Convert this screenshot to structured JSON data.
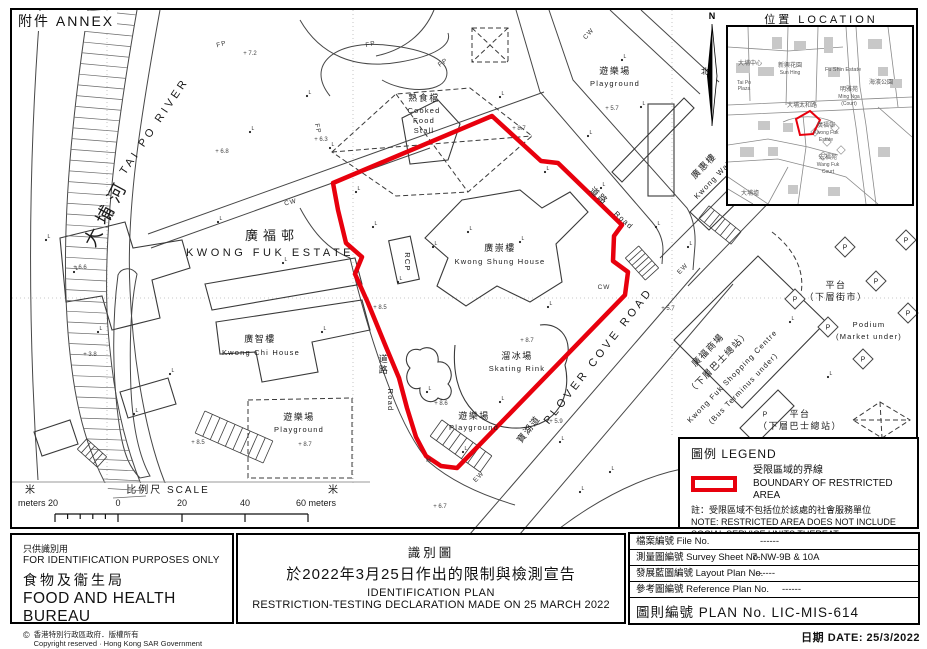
{
  "annex": "附件 ANNEX",
  "red": "#e8000d",
  "inset": {
    "title": "位置 LOCATION",
    "north": "N",
    "north_cn": "北",
    "red_poly": [
      [
        68,
        92
      ],
      [
        82,
        84
      ],
      [
        92,
        93
      ],
      [
        85,
        107
      ],
      [
        72,
        108
      ]
    ],
    "labels": [
      {
        "t": "新興花園",
        "x": 62,
        "y": 40,
        "s": 6
      },
      {
        "t": "Sun Hing",
        "x": 62,
        "y": 47,
        "s": 5
      },
      {
        "t": "Fu Shin Estate",
        "x": 115,
        "y": 44,
        "s": 5.5
      },
      {
        "t": "大埔中心",
        "x": 22,
        "y": 38,
        "s": 6
      },
      {
        "t": "Tai Po",
        "x": 16,
        "y": 57,
        "s": 5
      },
      {
        "t": "Plaza",
        "x": 16,
        "y": 63,
        "s": 5
      },
      {
        "t": "明雅苑",
        "x": 121,
        "y": 64,
        "s": 6
      },
      {
        "t": "Ming Nga",
        "x": 121,
        "y": 71,
        "s": 5
      },
      {
        "t": "(Court)",
        "x": 121,
        "y": 78,
        "s": 5
      },
      {
        "t": "大埔太和路",
        "x": 74,
        "y": 80,
        "s": 6
      },
      {
        "t": "海濱公園",
        "x": 153,
        "y": 57,
        "s": 6
      },
      {
        "t": "廣福邨",
        "x": 98,
        "y": 100,
        "s": 6
      },
      {
        "t": "Kwong Fuk",
        "x": 98,
        "y": 107,
        "s": 5
      },
      {
        "t": "Estate",
        "x": 98,
        "y": 114,
        "s": 5
      },
      {
        "t": "宏福苑",
        "x": 100,
        "y": 132,
        "s": 6
      },
      {
        "t": "Wang Fuk",
        "x": 100,
        "y": 139,
        "s": 5
      },
      {
        "t": "Court",
        "x": 100,
        "y": 146,
        "s": 5
      },
      {
        "t": "大埔墟",
        "x": 22,
        "y": 168,
        "s": 6
      }
    ]
  },
  "legend": {
    "title": "圖例 LEGEND",
    "item_cn": "受限區域的界線",
    "item_en": "BOUNDARY OF RESTRICTED AREA",
    "note_cn": "註：受限區域不包括位於該處的社會服務單位",
    "note_en1": "NOTE: RESTRICTED AREA DOES NOT INCLUDE",
    "note_en2": "SOCIAL SERVICE UNITS THEREAT"
  },
  "scalebar": {
    "cn_left": "米",
    "cn_right": "米",
    "title": "比例尺  SCALE",
    "left_label": "meters 20",
    "zero": "0",
    "tick20": "20",
    "tick40": "40",
    "right_label": "60 meters"
  },
  "title_block": {
    "use_cn": "只供識別用",
    "use_en": "FOR IDENTIFICATION PURPOSES ONLY",
    "bureau_cn": "食物及衞生局",
    "bureau_en": "FOOD AND HEALTH BUREAU",
    "copy_symbol": "©",
    "copy_cn": "香港特別行政區政府．版權所有",
    "copy_en": "Copyright reserved · Hong Kong SAR Government"
  },
  "plan_title": {
    "cn1": "識別圖",
    "cn2": "於2022年3月25日作出的限制與檢測宣告",
    "en1": "IDENTIFICATION PLAN",
    "en2": "RESTRICTION-TESTING DECLARATION MADE ON 25 MARCH 2022"
  },
  "info": {
    "rows": [
      {
        "label": "檔案編號 File No.",
        "value": "------"
      },
      {
        "label": "測量圖編號 Survey Sheet No.",
        "value": "7-NW-9B  &  10A"
      },
      {
        "label": "發展藍圖編號 Layout Plan No.",
        "value": "------"
      },
      {
        "label": "參考圖編號 Reference Plan No.",
        "value": "------"
      }
    ],
    "plan_no": "圖則編號  PLAN  No.  LIC-MIS-614",
    "date": "日期  DATE:  25/3/2022"
  },
  "map": {
    "boundary": [
      [
        492,
        116
      ],
      [
        333,
        183
      ],
      [
        338,
        210
      ],
      [
        346,
        243
      ],
      [
        362,
        257
      ],
      [
        355,
        274
      ],
      [
        368,
        303
      ],
      [
        386,
        347
      ],
      [
        399,
        378
      ],
      [
        407,
        408
      ],
      [
        416,
        437
      ],
      [
        426,
        456
      ],
      [
        441,
        466
      ],
      [
        457,
        468
      ],
      [
        625,
        295
      ],
      [
        628,
        272
      ],
      [
        613,
        261
      ],
      [
        614,
        236
      ],
      [
        622,
        225
      ],
      [
        558,
        163
      ],
      [
        541,
        161
      ]
    ],
    "labels": [
      {
        "t": "大埔河",
        "x": 112,
        "y": 215,
        "r": -62,
        "c": "riv"
      },
      {
        "t": "TAI PO RIVER",
        "x": 157,
        "y": 128,
        "r": -56,
        "c": "enwide"
      },
      {
        "t": "廣福邨",
        "x": 272,
        "y": 240,
        "c": "cnbig"
      },
      {
        "t": "KWONG FUK ESTATE",
        "x": 270,
        "y": 256,
        "c": "enwide"
      },
      {
        "t": "廣崇樓",
        "x": 500,
        "y": 251,
        "c": "cn"
      },
      {
        "t": "Kwong Shung House",
        "x": 500,
        "y": 264,
        "c": "en"
      },
      {
        "t": "廣智樓",
        "x": 260,
        "y": 342,
        "c": "cn"
      },
      {
        "t": "Kwong Chi House",
        "x": 261,
        "y": 355,
        "c": "en"
      },
      {
        "t": "熟食檔",
        "x": 424,
        "y": 101,
        "s": 8,
        "c": "cn"
      },
      {
        "t": "Cooked",
        "x": 424,
        "y": 113,
        "c": "en"
      },
      {
        "t": "Food",
        "x": 424,
        "y": 123,
        "c": "en"
      },
      {
        "t": "Stall",
        "x": 424,
        "y": 133,
        "c": "en"
      },
      {
        "t": "溜冰場",
        "x": 517,
        "y": 359,
        "s": 8,
        "c": "cn"
      },
      {
        "t": "Skating Rink",
        "x": 517,
        "y": 371,
        "c": "en"
      },
      {
        "t": "遊樂場",
        "x": 615,
        "y": 74,
        "s": 8,
        "c": "cn"
      },
      {
        "t": "Playground",
        "x": 615,
        "y": 86,
        "c": "en"
      },
      {
        "t": "遊樂場",
        "x": 299,
        "y": 420,
        "s": 8,
        "c": "cn"
      },
      {
        "t": "Playground",
        "x": 299,
        "y": 432,
        "c": "en"
      },
      {
        "t": "遊樂場",
        "x": 474,
        "y": 419,
        "s": 8,
        "c": "cn"
      },
      {
        "t": "Playground",
        "x": 474,
        "y": 430,
        "c": "en"
      },
      {
        "t": "PLOVER COVE ROAD",
        "x": 601,
        "y": 358,
        "r": -52,
        "c": "enwide",
        "s": 10
      },
      {
        "t": "寶湖道",
        "x": 531,
        "y": 431,
        "r": -52,
        "s": 10,
        "c": "cn"
      },
      {
        "t": "道",
        "x": 384,
        "y": 362,
        "c": "cn"
      },
      {
        "t": "路",
        "x": 384,
        "y": 373,
        "c": "cn"
      },
      {
        "t": "Road",
        "x": 388,
        "y": 400,
        "r": 90,
        "c": "en"
      },
      {
        "t": "道路",
        "x": 597,
        "y": 198,
        "r": 42,
        "s": 8,
        "c": "cn"
      },
      {
        "t": "Road",
        "x": 622,
        "y": 222,
        "r": 42,
        "c": "en"
      },
      {
        "t": "廣惠樓",
        "x": 706,
        "y": 168,
        "r": -46,
        "s": 8,
        "c": "cn"
      },
      {
        "t": "Kwong Wai",
        "x": 714,
        "y": 182,
        "r": -46,
        "s": 7,
        "c": "en"
      },
      {
        "t": "平台",
        "x": 836,
        "y": 288,
        "c": "cn"
      },
      {
        "t": "（下層街市）",
        "x": 836,
        "y": 300,
        "s": 8.5,
        "c": "cn"
      },
      {
        "t": "Podium",
        "x": 869,
        "y": 327,
        "c": "en"
      },
      {
        "t": "(Market  under)",
        "x": 869,
        "y": 339,
        "c": "en"
      },
      {
        "t": "平台",
        "x": 800,
        "y": 417,
        "c": "cn"
      },
      {
        "t": "（下層巴士總站）",
        "x": 800,
        "y": 429,
        "s": 8.5,
        "c": "cn"
      },
      {
        "t": "廣福商場",
        "x": 710,
        "y": 352,
        "r": -46,
        "s": 8,
        "c": "cn"
      },
      {
        "t": "（下層巴士總站）",
        "x": 721,
        "y": 364,
        "r": -46,
        "s": 7.5,
        "c": "cn"
      },
      {
        "t": "Kwong Fuk Shopping Centre",
        "x": 734,
        "y": 378,
        "r": -46,
        "s": 6.5,
        "c": "en"
      },
      {
        "t": "(Bus Terminus under)",
        "x": 745,
        "y": 390,
        "r": -46,
        "s": 6.5,
        "c": "en"
      },
      {
        "t": "RCP",
        "x": 405,
        "y": 262,
        "r": 90,
        "s": 7,
        "c": "en"
      }
    ],
    "small_marks": [
      {
        "t": "FP",
        "x": 371,
        "y": 46,
        "r": -12
      },
      {
        "t": "FP",
        "x": 444,
        "y": 64,
        "r": -35
      },
      {
        "t": "FP",
        "x": 316,
        "y": 129,
        "r": 78
      },
      {
        "t": "FP",
        "x": 222,
        "y": 46,
        "r": -15
      },
      {
        "t": "CW",
        "x": 291,
        "y": 204,
        "r": -13
      },
      {
        "t": "CW",
        "x": 604,
        "y": 289,
        "r": 0
      },
      {
        "t": "CW",
        "x": 590,
        "y": 35,
        "r": -48
      },
      {
        "t": "EW",
        "x": 684,
        "y": 270,
        "r": -46
      },
      {
        "t": "EW",
        "x": 480,
        "y": 478,
        "r": -46
      },
      {
        "t": "H",
        "x": 429,
        "y": 462,
        "r": 0
      }
    ],
    "l_markers": [
      [
        46,
        240
      ],
      [
        74,
        272
      ],
      [
        98,
        332
      ],
      [
        134,
        414
      ],
      [
        170,
        374
      ],
      [
        110,
        218
      ],
      [
        218,
        222
      ],
      [
        250,
        132
      ],
      [
        307,
        96
      ],
      [
        330,
        148
      ],
      [
        283,
        263
      ],
      [
        322,
        332
      ],
      [
        356,
        192
      ],
      [
        373,
        227
      ],
      [
        398,
        282
      ],
      [
        433,
        247
      ],
      [
        468,
        232
      ],
      [
        520,
        242
      ],
      [
        548,
        307
      ],
      [
        500,
        402
      ],
      [
        463,
        452
      ],
      [
        427,
        392
      ],
      [
        560,
        442
      ],
      [
        588,
        136
      ],
      [
        622,
        60
      ],
      [
        641,
        107
      ],
      [
        656,
        227
      ],
      [
        688,
        247
      ],
      [
        736,
        177
      ],
      [
        790,
        322
      ],
      [
        828,
        377
      ],
      [
        580,
        492
      ],
      [
        610,
        472
      ],
      [
        500,
        97
      ],
      [
        545,
        172
      ],
      [
        601,
        188
      ]
    ],
    "spots": [
      {
        "t": "8.7",
        "x": 527,
        "y": 342
      },
      {
        "t": "8.7",
        "x": 519,
        "y": 130
      },
      {
        "t": "8.6",
        "x": 441,
        "y": 405
      },
      {
        "t": "8.5",
        "x": 380,
        "y": 309
      },
      {
        "t": "8.5",
        "x": 198,
        "y": 444
      },
      {
        "t": "8.7",
        "x": 305,
        "y": 446
      },
      {
        "t": "6.7",
        "x": 440,
        "y": 508
      },
      {
        "t": "5.9",
        "x": 556,
        "y": 423
      },
      {
        "t": "5.7",
        "x": 668,
        "y": 310
      },
      {
        "t": "5.7",
        "x": 612,
        "y": 110
      },
      {
        "t": "6.6",
        "x": 80,
        "y": 269
      },
      {
        "t": "3.8",
        "x": 90,
        "y": 356
      },
      {
        "t": "6.8",
        "x": 222,
        "y": 153
      },
      {
        "t": "7.2",
        "x": 250,
        "y": 55
      },
      {
        "t": "6.3",
        "x": 321,
        "y": 141
      }
    ],
    "p_markers": [
      {
        "x": 845,
        "y": 247,
        "d": true
      },
      {
        "x": 876,
        "y": 281,
        "d": true
      },
      {
        "x": 795,
        "y": 299,
        "d": true
      },
      {
        "x": 828,
        "y": 327,
        "d": true
      },
      {
        "x": 863,
        "y": 359,
        "d": true
      },
      {
        "x": 906,
        "y": 240,
        "d": true
      },
      {
        "x": 908,
        "y": 313,
        "d": true
      },
      {
        "x": 765,
        "y": 414,
        "d": false
      }
    ]
  }
}
